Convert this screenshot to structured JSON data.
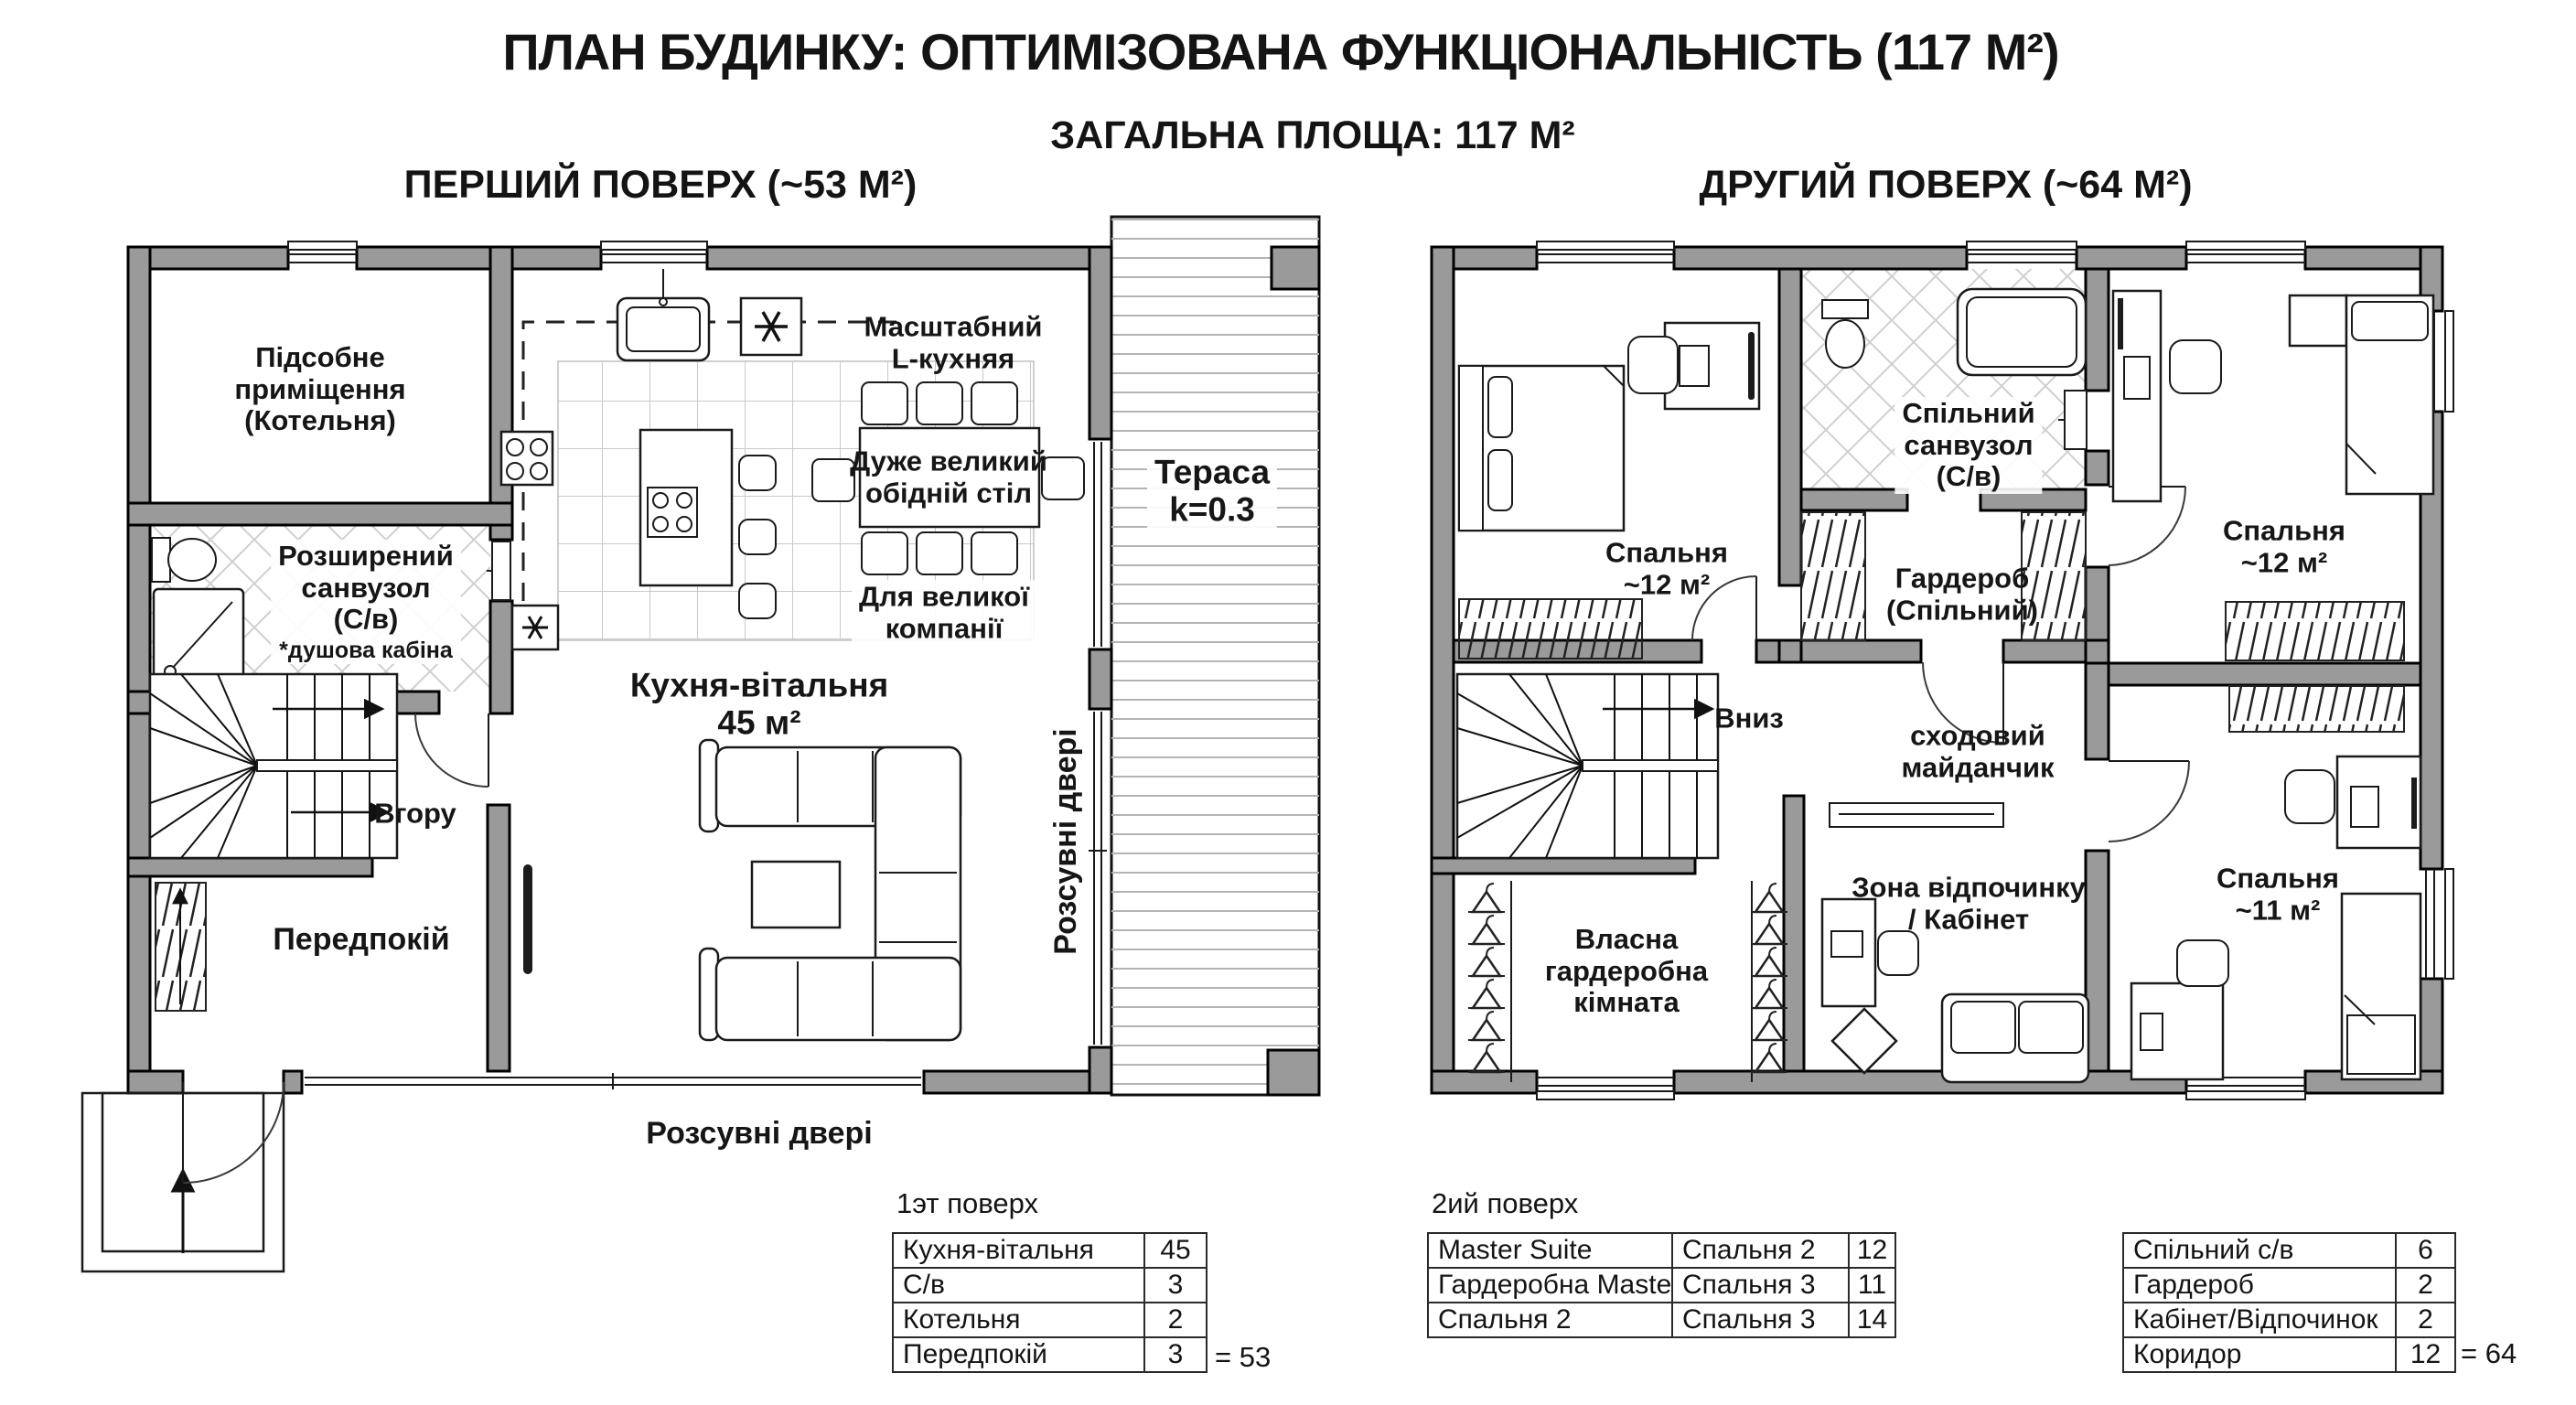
{
  "title": "ПЛАН БУДИНКУ: ОПТИМІЗОВАНА ФУНКЦІОНАЛЬНІСТЬ (117 М²)",
  "subtitle": "ЗАГАЛЬНА ПЛОЩА: 117 М²",
  "floor1": {
    "header": "ПЕРШИЙ ПОВЕРХ (~53 М²)",
    "rooms": {
      "utility": [
        "Підсобне",
        "приміщення",
        "(Котельня)"
      ],
      "bath": [
        "Розширений",
        "санвузол",
        "(С/в)"
      ],
      "bath_note": "*душова кабіна",
      "kitchen_type": [
        "Масштабний",
        "L-кухняя"
      ],
      "dining_table": [
        "Дуже великий",
        "обідній стіл"
      ],
      "dining_note": [
        "Для великої",
        "компанії"
      ],
      "terrace": [
        "Тераса",
        "k=0.3"
      ],
      "living": [
        "Кухня-вітальня",
        "45 м²"
      ],
      "up": "Вгору",
      "hall": "Передпокій",
      "sliding_right": "Розсувні двері",
      "sliding_bottom": "Розсувні двері"
    }
  },
  "floor2": {
    "header": "ДРУГИЙ ПОВЕРХ (~64 М²)",
    "rooms": {
      "master": [
        "Спальня",
        "~12 м²"
      ],
      "shared_bath": [
        "Спільний",
        "санвузол",
        "(С/в)"
      ],
      "shared_wardrobe": [
        "Гардероб",
        "(Спільний)"
      ],
      "bedroom2": [
        "Спальня",
        "~12 м²"
      ],
      "down": "Вниз",
      "landing": [
        "сходовий",
        "майданчик"
      ],
      "rest": [
        "Зона відпочинку",
        "/ Кабінет"
      ],
      "own_wardrobe": [
        "Власна",
        "гардеробна",
        "кімната"
      ],
      "bedroom3": [
        "Спальня",
        "~11 м²"
      ]
    }
  },
  "tables": {
    "f1": {
      "header": "1эт поверх",
      "rows": [
        {
          "name": "Кухня-вітальня",
          "value": "45"
        },
        {
          "name": "С/в",
          "value": "3"
        },
        {
          "name": "Котельня",
          "value": "2"
        },
        {
          "name": "Передпокій",
          "value": "3"
        }
      ],
      "total": "= 53"
    },
    "f2": {
      "header": "2ий поверх",
      "a_rows": [
        {
          "name": "Master Suite",
          "value": "16"
        },
        {
          "name": "Гардеробна Master",
          "value": "3"
        },
        {
          "name": "Спальня 2",
          "value": "12"
        }
      ],
      "b_rows": [
        {
          "name": "Спальня 2",
          "value": "12"
        },
        {
          "name": "Спальня 3",
          "value": "11"
        },
        {
          "name": "Спальня 3",
          "value": "14"
        }
      ],
      "c_rows": [
        {
          "name": "Спільний с/в",
          "value": "6"
        },
        {
          "name": "Гардероб",
          "value": "2"
        },
        {
          "name": "Кабінет/Відпочинок",
          "value": "2"
        },
        {
          "name": "Коридор",
          "value": "12"
        }
      ],
      "total": "= 64"
    }
  }
}
